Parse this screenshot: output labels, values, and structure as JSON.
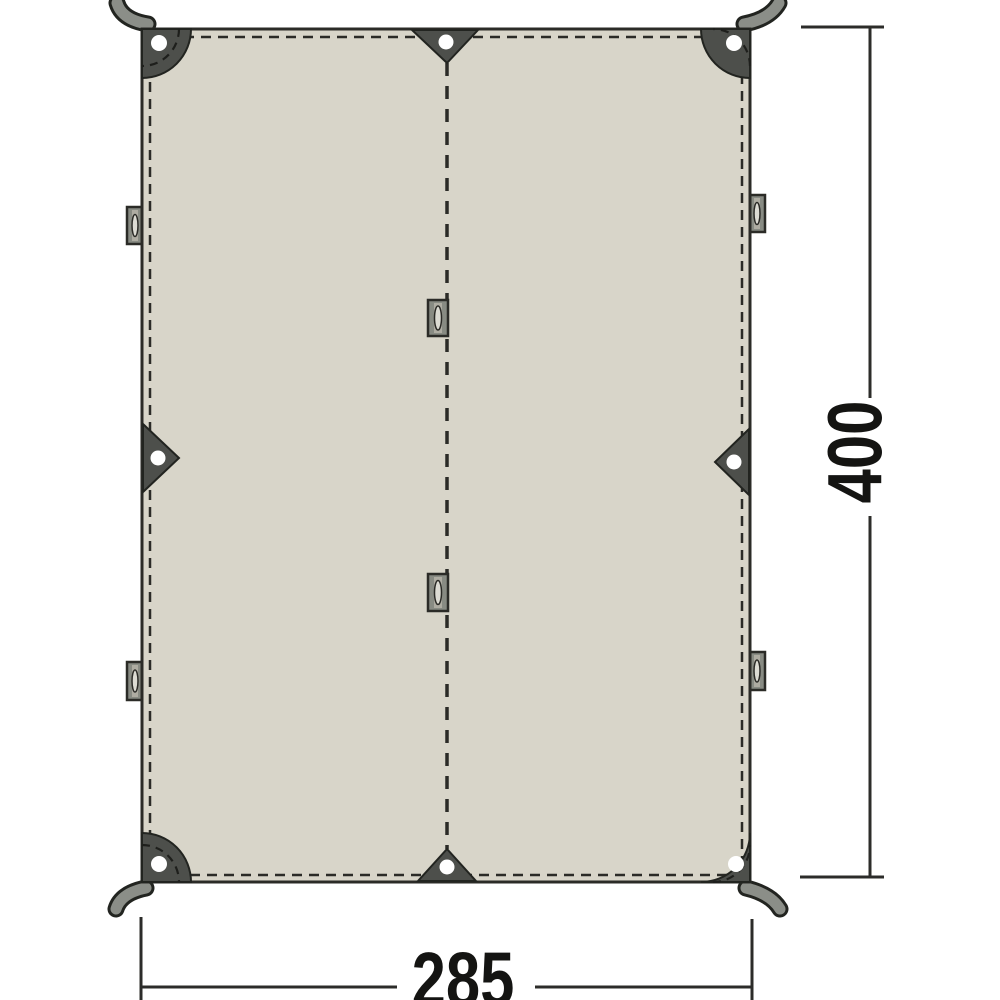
{
  "diagram": {
    "type": "tarp-dimension-diagram",
    "dimension_labels": {
      "width": "285",
      "height": "400"
    },
    "parts": {
      "corner_reinforcement_patches": 4,
      "corner_grommets": 4,
      "corner_straps": 4,
      "edge_grommet_triangles": 4,
      "edge_webbing_tabs": 4,
      "center_seam_loops": 2,
      "center_seam": 1
    },
    "colors": {
      "background": "#ffffff",
      "fabric": "#d8d5c9",
      "fabric_outline": "#2b2b27",
      "patch": "#4d4f4b",
      "patch_outline": "#222420",
      "strap": "#8b8e88",
      "tab_fill": "#888b83",
      "tab_stripe": "#aeaca2",
      "slot": "#dcdbd3",
      "grommet": "#ffffff",
      "dimension_line": "#2c2c2a",
      "label_text": "#141412"
    }
  }
}
